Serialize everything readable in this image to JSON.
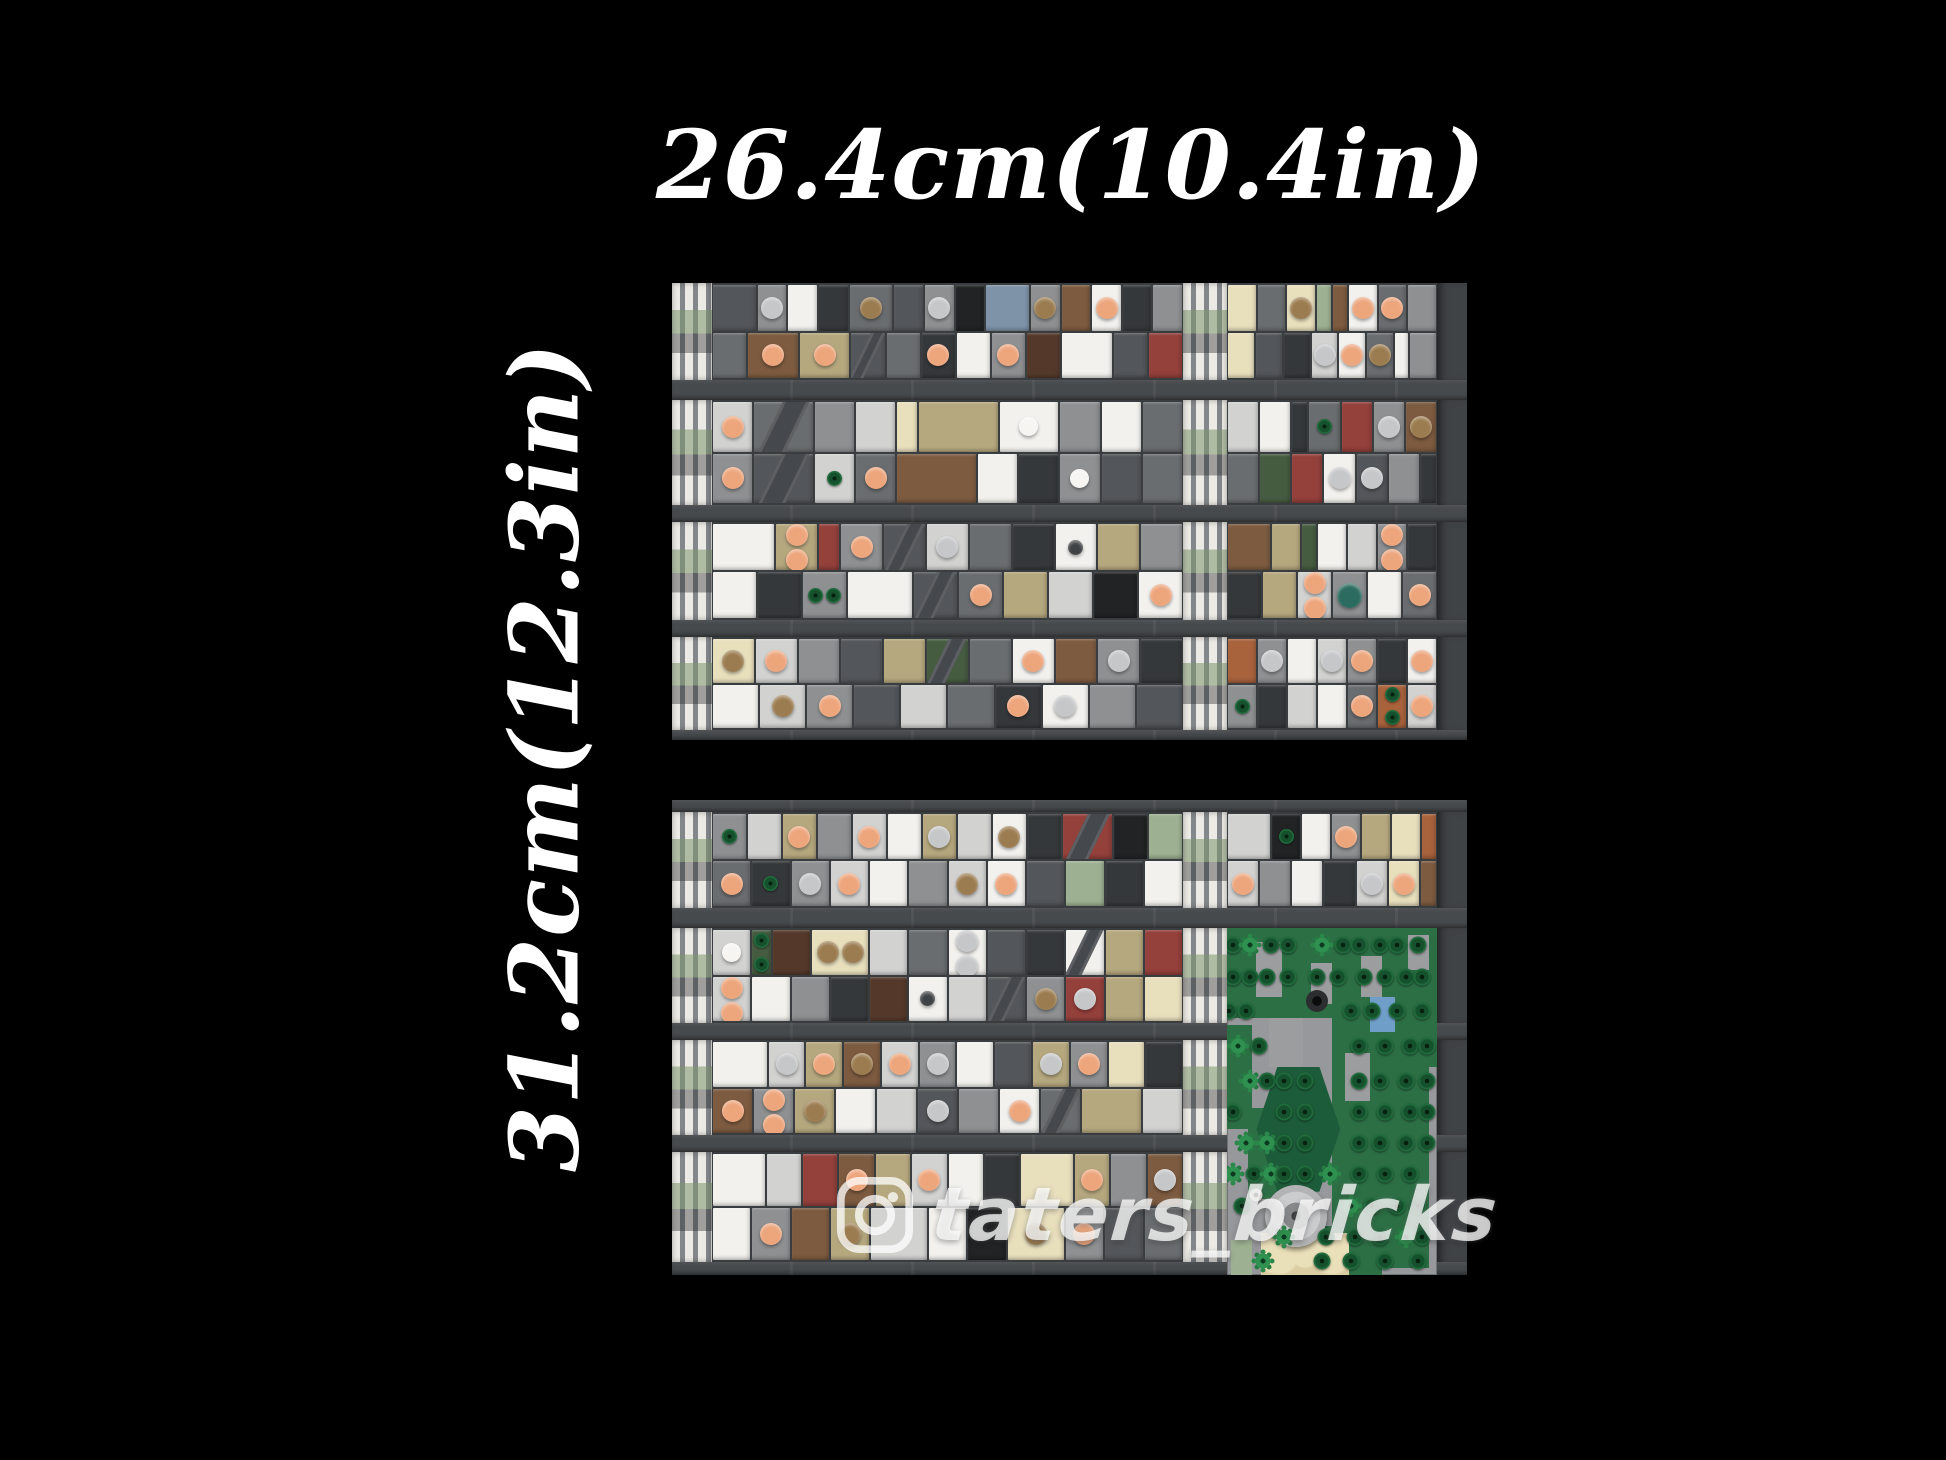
{
  "labels": {
    "top_dimension": "26.4cm(10.4in)",
    "left_dimension": "31.2cm(12.3in)"
  },
  "watermark": {
    "icon": "instagram-icon",
    "handle": "taters_bricks",
    "color": "rgba(255,255,255,0.75)"
  },
  "colors": {
    "background": "#000000",
    "street": "#474a4d",
    "panel_base": "#3a3d40",
    "sidewalk_stripe": "#eceae5",
    "sidewalk_base": "#83868a",
    "label_text": "#ffffff"
  },
  "palette": {
    "W": "#f2f1ee",
    "L": "#d2d2d1",
    "M": "#8e9092",
    "D": "#6a6d6f",
    "C": "#53565a",
    "K": "#35383a",
    "A": "#212324",
    "T": "#b5a77e",
    "F": "#e8dfbd",
    "B": "#7d5b40",
    "N": "#54392a",
    "R": "#94403b",
    "V": "#465c41",
    "S": "#9db192",
    "U": "#7e93a8",
    "O": "#a8623c"
  },
  "ornament_colors": {
    "p": "#eda57c",
    "g": "#c6c7c9",
    "t": "#9b7c50",
    "w": "#f6f5f2",
    "d": "#3f4244",
    "e": "#2c6b5f"
  },
  "panels": {
    "top": {
      "x": 672,
      "y": 283,
      "w": 795,
      "h": 457,
      "cols": [
        40,
        471,
        44,
        210,
        30
      ],
      "rows": [
        {
          "kind": "block",
          "h": 97,
          "left": {
            "t": [
              "C:3",
              "M:2:g",
              "W:2",
              "K:2",
              "D:3:t",
              "C:2",
              "M:2:g",
              "A:2",
              "U:3",
              "M:2:t",
              "B:2",
              "W:2:p",
              "K:2",
              "M:2"
            ],
            "b": [
              "D:2",
              "B:3:p",
              "T:3:p",
              "C:2:x",
              "D:2",
              "K:2:p",
              "W:2",
              "M:2:p",
              "N:2",
              "W:3",
              "C:2",
              "R:2"
            ]
          },
          "right": {
            "t": [
              "F:2",
              "D:2",
              "F:2:t",
              "S:1",
              "B:1",
              "W:2:p",
              "D:2:p",
              "M:2"
            ],
            "b": [
              "F:2",
              "C:2",
              "K:2",
              "L:2:g",
              "W:2:p",
              "D:2:t",
              "W:1",
              "M:2"
            ]
          }
        },
        {
          "kind": "street",
          "h": 20
        },
        {
          "kind": "block",
          "h": 105,
          "left": {
            "t": [
              "L:2:p",
              "D:3:x",
              "M:2",
              "L:2",
              "F:1",
              "T:4",
              "W:3:w",
              "M:2",
              "W:2",
              "D:2"
            ],
            "b": [
              "M:2:p",
              "C:3:x",
              "L:2:r",
              "D:2:p",
              "B:4",
              "W:2",
              "K:2",
              "M:2:w",
              "C:2",
              "D:2"
            ]
          },
          "right": {
            "t": [
              "L:2",
              "W:2",
              "K:1",
              "D:2:r",
              "R:2",
              "M:2:g",
              "B:2:t"
            ],
            "b": [
              "D:2",
              "V:2",
              "R:2",
              "W:2:g",
              "C:2:g",
              "M:2",
              "K:1"
            ]
          }
        },
        {
          "kind": "street",
          "h": 17
        },
        {
          "kind": "block",
          "h": 98,
          "left": {
            "t": [
              "W:3",
              "T:2:p2",
              "R:1",
              "M:2:p",
              "C:2:x",
              "L:2:g",
              "D:2",
              "K:2",
              "W:2:d",
              "T:2",
              "M:2"
            ],
            "b": [
              "W:2",
              "K:2",
              "M:2:r2",
              "W:3",
              "C:2:x",
              "D:2:p",
              "T:2",
              "L:2",
              "A:2",
              "W:2:p"
            ]
          },
          "right": {
            "t": [
              "B:3",
              "T:2",
              "V:1",
              "W:2",
              "L:2",
              "M:2:p2",
              "K:2"
            ],
            "b": [
              "K:2",
              "T:2",
              "L:2:p2",
              "M:2:e",
              "W:2",
              "D:2:p"
            ]
          }
        },
        {
          "kind": "street",
          "h": 17
        },
        {
          "kind": "block",
          "h": 93,
          "left": {
            "t": [
              "F:2:t",
              "L:2:p",
              "M:2",
              "C:2",
              "T:2",
              "V:2:x",
              "D:2",
              "W:2:p",
              "B:2",
              "M:2:g",
              "K:2"
            ],
            "b": [
              "W:2",
              "L:2:t",
              "M:2:p",
              "C:2",
              "L:2",
              "D:2",
              "K:2:p",
              "W:2:g",
              "M:2",
              "C:2"
            ]
          },
          "right": {
            "t": [
              "O:2",
              "M:2:g",
              "W:2",
              "L:2:g",
              "M:2:p",
              "K:2",
              "W:2:p"
            ],
            "b": [
              "M:2:r",
              "K:2",
              "L:2",
              "W:2",
              "D:2:p",
              "O:2:r2",
              "L:2:p"
            ]
          }
        },
        {
          "kind": "street",
          "h": 10
        }
      ]
    },
    "bottom": {
      "x": 672,
      "y": 800,
      "w": 795,
      "h": 475,
      "cols": [
        40,
        471,
        44,
        210,
        30
      ],
      "rows": [
        {
          "kind": "street",
          "h": 12
        },
        {
          "kind": "block",
          "h": 96,
          "left": {
            "t": [
              "M:2:r",
              "L:2",
              "T:2:p",
              "M:2",
              "L:2:p",
              "W:2",
              "T:2:g",
              "L:2",
              "W:2:t",
              "K:2",
              "R:3:x",
              "A:2",
              "S:2"
            ],
            "b": [
              "D:2:p",
              "K:2:r",
              "M:2:g",
              "L:2:p",
              "W:2",
              "M:2",
              "L:2:t",
              "W:2:p",
              "C:2",
              "S:2",
              "K:2",
              "W:2"
            ]
          },
          "right": {
            "t": [
              "L:3",
              "A:2:r",
              "W:2",
              "M:2:p",
              "T:2",
              "F:2",
              "O:1"
            ],
            "b": [
              "L:2:p",
              "M:2",
              "W:2",
              "K:2",
              "L:2:g",
              "F:2:p",
              "B:1"
            ]
          }
        },
        {
          "kind": "street",
          "h": 20
        },
        {
          "kind": "block",
          "h": 95,
          "left": {
            "t": [
              "L:2:w",
              "V:1:r2",
              "N:2",
              "F:3:t2",
              "L:2",
              "D:2",
              "W:2:g2",
              "C:2",
              "K:2",
              "W:2:x",
              "T:2",
              "R:2"
            ],
            "b": [
              "L:2:p2",
              "W:2",
              "M:2",
              "K:2",
              "N:2",
              "W:2:d",
              "L:2",
              "C:2:x",
              "M:2:t",
              "R:2:g",
              "T:2",
              "F:2"
            ]
          },
          "right": null
        },
        {
          "kind": "street",
          "h": 17
        },
        {
          "kind": "block",
          "h": 95,
          "left": {
            "t": [
              "W:3",
              "L:2:g",
              "T:2:p",
              "B:2:t",
              "L:2:p",
              "M:2:g",
              "W:2",
              "C:2",
              "T:2:g",
              "M:2:p",
              "F:2",
              "K:2"
            ],
            "b": [
              "B:2:p",
              "M:2:p2",
              "T:2:t",
              "W:2",
              "L:2",
              "C:2:g",
              "M:2",
              "W:2:p",
              "D:2:x",
              "T:3",
              "L:2"
            ]
          },
          "right": null
        },
        {
          "kind": "street",
          "h": 17
        },
        {
          "kind": "block",
          "h": 110,
          "left": {
            "t": [
              "W:3",
              "L:2",
              "R:2",
              "B:2:p",
              "T:2",
              "L:2:p",
              "W:2",
              "K:2",
              "F:3",
              "T:2:p",
              "M:2",
              "B:2:g"
            ],
            "b": [
              "W:2",
              "M:2:p",
              "B:2",
              "T:2:t",
              "L:3",
              "W:2",
              "A:2",
              "F:3:t",
              "M:2:p",
              "C:2",
              "D:2"
            ]
          },
          "right": null
        },
        {
          "kind": "street",
          "h": 13
        }
      ]
    }
  },
  "park": {
    "rect": {
      "x": 555,
      "y": 128,
      "w": 210,
      "h": 347
    },
    "ground": "#96989b",
    "green": "#2c6f45",
    "paving": "#9b9d9f",
    "hex_color": "#1d5c3a",
    "green_patches": [
      [
        0,
        0,
        100,
        26
      ],
      [
        50,
        26,
        46,
        72
      ],
      [
        0,
        28,
        12,
        30
      ],
      [
        10,
        52,
        20,
        26
      ],
      [
        28,
        86,
        46,
        14
      ],
      [
        86,
        20,
        14,
        20
      ]
    ],
    "gray_patches": [
      [
        14,
        4,
        12,
        16
      ],
      [
        40,
        10,
        10,
        12
      ],
      [
        64,
        8,
        10,
        12
      ],
      [
        86,
        2,
        10,
        10
      ],
      [
        56,
        36,
        12,
        14
      ],
      [
        20,
        26,
        16,
        14
      ]
    ],
    "hexagon": {
      "x": 14,
      "y": 40,
      "w": 40,
      "h": 36
    },
    "pond": {
      "x": 68,
      "y": 20,
      "w": 12,
      "h": 10,
      "color": "#6f9fc8"
    },
    "bush": {
      "x": 43,
      "y": 21,
      "d": 22
    },
    "fountain": {
      "x": 33,
      "y": 83,
      "d": 62
    },
    "walkway": {
      "x": 16,
      "y": 88,
      "w": 42,
      "h": 12,
      "color": "#dbcda3"
    },
    "sage_tile": {
      "x": 2,
      "y": 90,
      "w": 10,
      "h": 10,
      "color": "#9db192"
    },
    "white_dot": {
      "x": 14,
      "y": 77,
      "d": 13
    },
    "trees": [
      [
        3,
        5,
        "d"
      ],
      [
        11,
        5,
        "l"
      ],
      [
        21,
        5,
        "d"
      ],
      [
        29,
        5,
        "d"
      ],
      [
        45,
        5,
        "l"
      ],
      [
        55,
        5,
        "d"
      ],
      [
        63,
        5,
        "d"
      ],
      [
        73,
        5,
        "d"
      ],
      [
        81,
        5,
        "d"
      ],
      [
        91,
        5,
        "d"
      ],
      [
        3,
        14,
        "d"
      ],
      [
        11,
        14,
        "d"
      ],
      [
        19,
        14,
        "d"
      ],
      [
        29,
        14,
        "d"
      ],
      [
        43,
        14,
        "d"
      ],
      [
        53,
        14,
        "d"
      ],
      [
        65,
        14,
        "d"
      ],
      [
        75,
        14,
        "d"
      ],
      [
        85,
        14,
        "d"
      ],
      [
        93,
        14,
        "d"
      ],
      [
        1,
        24,
        "d"
      ],
      [
        9,
        24,
        "d"
      ],
      [
        59,
        24,
        "d"
      ],
      [
        69,
        24,
        "d"
      ],
      [
        81,
        24,
        "d"
      ],
      [
        93,
        24,
        "d"
      ],
      [
        5,
        34,
        "l"
      ],
      [
        15,
        34,
        "d"
      ],
      [
        63,
        34,
        "d"
      ],
      [
        75,
        34,
        "d"
      ],
      [
        87,
        34,
        "d"
      ],
      [
        95,
        34,
        "d"
      ],
      [
        11,
        44,
        "l"
      ],
      [
        19,
        44,
        "d"
      ],
      [
        27,
        44,
        "d"
      ],
      [
        37,
        44,
        "d"
      ],
      [
        63,
        44,
        "d"
      ],
      [
        73,
        44,
        "d"
      ],
      [
        85,
        44,
        "d"
      ],
      [
        95,
        44,
        "d"
      ],
      [
        3,
        53,
        "d"
      ],
      [
        27,
        53,
        "d"
      ],
      [
        37,
        53,
        "d"
      ],
      [
        63,
        53,
        "d"
      ],
      [
        75,
        53,
        "d"
      ],
      [
        87,
        53,
        "d"
      ],
      [
        95,
        53,
        "d"
      ],
      [
        9,
        62,
        "l"
      ],
      [
        19,
        62,
        "l"
      ],
      [
        27,
        62,
        "d"
      ],
      [
        37,
        62,
        "d"
      ],
      [
        63,
        62,
        "d"
      ],
      [
        73,
        62,
        "d"
      ],
      [
        85,
        62,
        "d"
      ],
      [
        95,
        62,
        "d"
      ],
      [
        3,
        71,
        "l"
      ],
      [
        13,
        71,
        "d"
      ],
      [
        21,
        71,
        "l"
      ],
      [
        27,
        71,
        "d"
      ],
      [
        37,
        71,
        "d"
      ],
      [
        49,
        71,
        "l"
      ],
      [
        63,
        71,
        "d"
      ],
      [
        75,
        71,
        "d"
      ],
      [
        87,
        71,
        "d"
      ],
      [
        7,
        80,
        "d"
      ],
      [
        59,
        80,
        "l"
      ],
      [
        69,
        80,
        "d"
      ],
      [
        81,
        80,
        "d"
      ],
      [
        91,
        80,
        "d"
      ],
      [
        27,
        89,
        "l"
      ],
      [
        47,
        89,
        "d"
      ],
      [
        61,
        89,
        "d"
      ],
      [
        73,
        89,
        "d"
      ],
      [
        85,
        89,
        "l"
      ],
      [
        93,
        89,
        "d"
      ],
      [
        17,
        96,
        "l"
      ],
      [
        45,
        96,
        "d"
      ],
      [
        59,
        96,
        "d"
      ],
      [
        75,
        96,
        "d"
      ],
      [
        91,
        96,
        "d"
      ]
    ]
  }
}
